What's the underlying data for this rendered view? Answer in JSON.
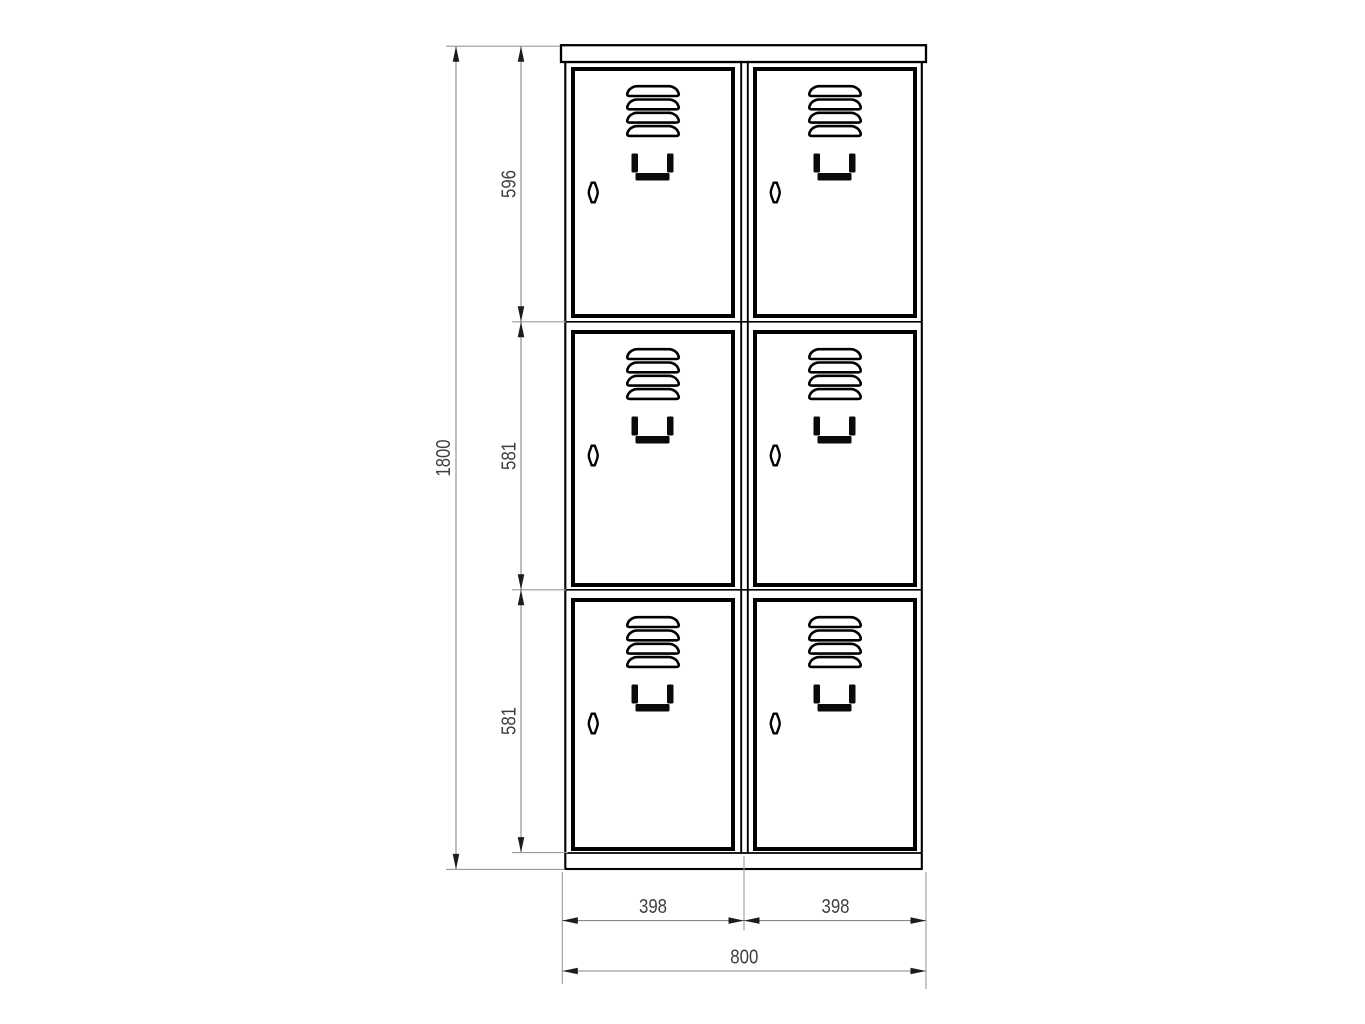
{
  "drawing": {
    "title": "Locker cabinet front view technical drawing",
    "background": "#ffffff",
    "line_color": "#000000",
    "dimension_line_color": "#8a8a8a",
    "dimension_text_color": "#3f3f3f"
  },
  "cabinet": {
    "columns": 2,
    "rows": 3,
    "doors": 6,
    "louvers_per_door": 4,
    "icons": [
      "vent-louver-icon",
      "door-handle-icon",
      "keyhole-icon"
    ]
  },
  "dims": {
    "total_height": "1800",
    "top_compartment_height": "596",
    "middle_compartment_height": "581",
    "bottom_compartment_height": "581",
    "left_door_width": "398",
    "right_door_width": "398",
    "total_width": "800"
  }
}
